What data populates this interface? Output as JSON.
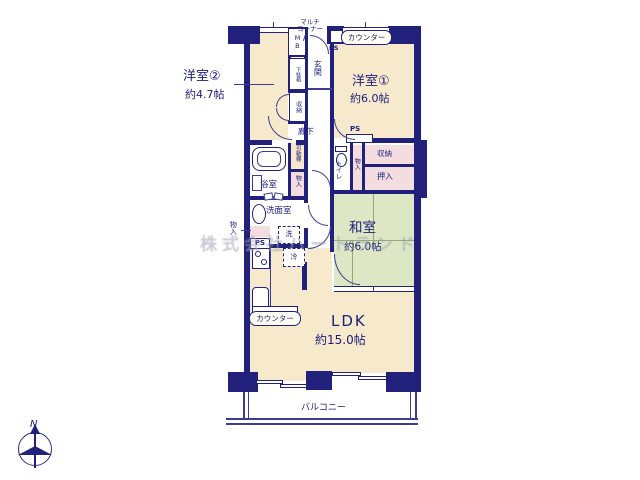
{
  "colors": {
    "wall": "#21217c",
    "room_cream": "#f6e9cc",
    "tatami_green": "#dde7c6",
    "closet_pink": "#f3dde1",
    "label_navy": "#1d1d7a"
  },
  "rooms": {
    "western2": {
      "name": "洋室②",
      "size": "約4.7帖"
    },
    "western1": {
      "name": "洋室①",
      "size": "約6.0帖"
    },
    "japanese": {
      "name": "和室",
      "size": "約6.0帖"
    },
    "ldk": {
      "name": "LDK",
      "size": "約15.0帖"
    },
    "balcony": {
      "name": "バルコニー"
    }
  },
  "labels": {
    "entrance": "玄関",
    "hallway": "廊下",
    "bathroom": "浴室",
    "washroom": "洗面室",
    "toilet": "トイレ",
    "shoe_cabinet": "下駄箱",
    "closet": "収納",
    "oshiire": "押入",
    "movable_shelf": "可動棚",
    "storage": "物入",
    "meter_box": "MB",
    "multi_corner_1": "マルチ",
    "multi_corner_2": "コーナー",
    "ps": "PS",
    "counter": "カウンター",
    "washer": "洗",
    "fridge": "冷",
    "north": "N",
    "watermark": "株式会社ハートランド"
  }
}
